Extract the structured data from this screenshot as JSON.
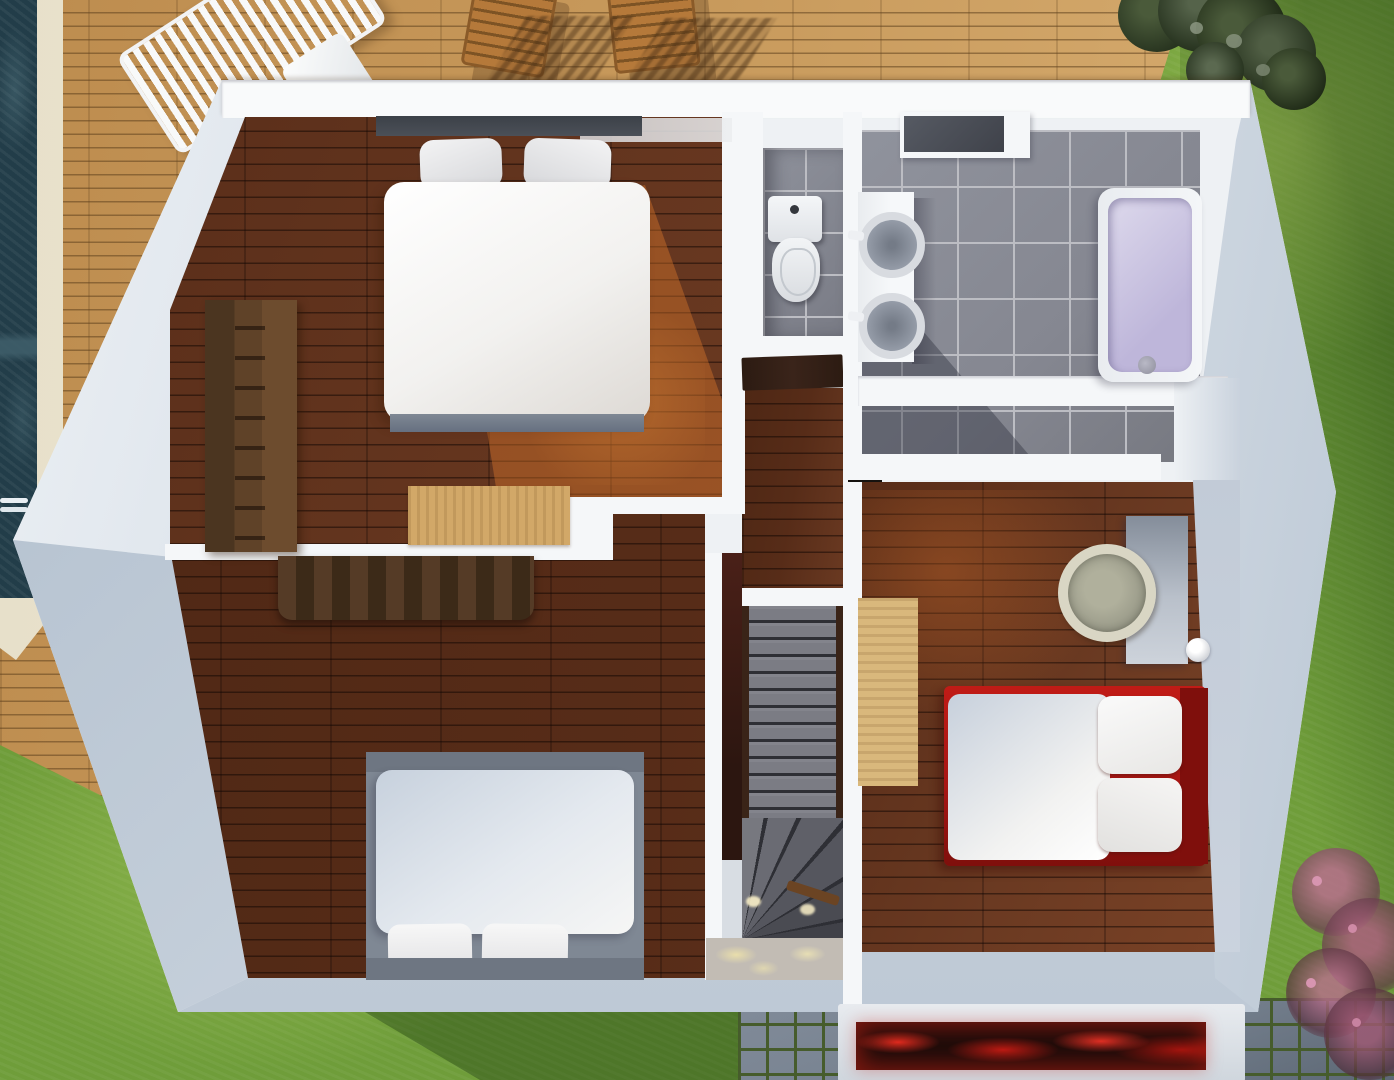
{
  "meta": {
    "description": "Top-down 3D architectural render of an upper-storey floor plan with surrounding garden, wooden pool deck and swimming pool",
    "view": "top-down-perspective",
    "width_px": 1394,
    "height_px": 1080,
    "visible_text": []
  },
  "palette": {
    "grassMid": "#6f9d3a",
    "grassLight": "#8db84e",
    "grassDark": "#45702a",
    "deckWood": "#c89a5c",
    "deckGap": "#936c3b",
    "poolWater": "#223d49",
    "poolStep": "#3e5d69",
    "copingCream": "#f1ebd7",
    "wallWhite": "#f5f7f9",
    "wallShade": "#bac7d6",
    "wallShadeDark": "#aebccb",
    "topBand": "#f9fafb",
    "floorWood": "#6b3a22",
    "floorWoodDark": "#572c18",
    "sunPatch": "#c9722f",
    "tileGray": "#858791",
    "tileGrout": "#bcbdc3",
    "stairTread": "#7b7c84",
    "stairGap": "#2e2f35",
    "stairWallRed": "#4a2018",
    "landing": "#c2bcb4",
    "caustic": "#efe5bc",
    "bedFrame": "#7f8894",
    "headboardDark": "#4b5058",
    "duvetWhite": "#f2f1ef",
    "duvetBlue": "#c7d1dd",
    "pillowWhite": "#ececee",
    "wardrobeBrown": "#5f4228",
    "dresserBrown": "#47311f",
    "rugTan": "#d2a868",
    "rugTan2": "#d9b87c",
    "redBed": "#a81613",
    "redBedDark": "#7f0f0c",
    "tubLavender": "#beb6da",
    "tubLavenderLight": "#ddd9ec",
    "sinkBowl": "#9aa1ad",
    "sinkRing": "#d8dbe0",
    "rattan": "#a9a893",
    "rattanLight": "#d9d6c4",
    "paver": "#75808e",
    "paverJoint": "#465c2c",
    "hedgeDark": "#26321e",
    "hedgeLight": "#4a5a3a",
    "shrubPink": "#b26d89",
    "shrubDark": "#6e4054",
    "flowerRed": "#cf2318",
    "planterDark": "#1a0b09",
    "doorBrown": "#3a241a",
    "furnitureWood": "#b5793a"
  },
  "scene": {
    "outdoor": {
      "pool": {
        "label": "swimming-pool",
        "water_color": "#223d49",
        "edge_color": "#f1ebd7",
        "features": [
          "step-band",
          "white-rail"
        ]
      },
      "deck": {
        "label": "wooden-pool-deck",
        "plank_direction": "horizontal"
      },
      "lawn": {
        "label": "lawn",
        "lighting": "diagonal-sun-and-shadow"
      },
      "hedge": {
        "label": "hedge-shrubs-top-right"
      },
      "pavers": {
        "label": "cobblestone-paving-bottom"
      },
      "planter": {
        "label": "planter-with-red-flowers",
        "flower_color": "#cf2318"
      },
      "pink_shrub": {
        "label": "pink-flowering-shrub-bottom-right"
      },
      "patio_furniture": [
        "white-slatted-lounger",
        "wooden-chair",
        "wooden-chair",
        "chair-shadows"
      ]
    },
    "rooms": [
      {
        "id": "master-bedroom",
        "position": "top-left",
        "floor": "dark-wood",
        "furniture": [
          "double-bed-white",
          "gray-headboard",
          "wardrobe-shelf-unit",
          "tan-rug"
        ]
      },
      {
        "id": "bedroom-2",
        "position": "bottom-left",
        "floor": "dark-wood",
        "furniture": [
          "double-bed-light-blue",
          "dark-dresser"
        ]
      },
      {
        "id": "bedroom-3",
        "position": "right",
        "floor": "dark-wood",
        "furniture": [
          "red-single-bed",
          "desk",
          "rattan-chair",
          "tan-rug",
          "desk-lamp"
        ]
      },
      {
        "id": "wc",
        "position": "top-center",
        "floor": "gray-tile",
        "furniture": [
          "toilet",
          "dark-door"
        ]
      },
      {
        "id": "bathroom",
        "position": "top-right",
        "floor": "gray-tile",
        "furniture": [
          "double-sink-vanity",
          "bathtub-lavender",
          "dark-top-cabinet"
        ]
      },
      {
        "id": "closet-niche",
        "position": "center-right",
        "floor": "dark-wood",
        "furniture": []
      },
      {
        "id": "hallway",
        "position": "center",
        "floor": "dark-wood",
        "furniture": []
      },
      {
        "id": "staircase",
        "position": "center",
        "parts": [
          "white-ledge",
          "straight-flight",
          "winder-steps",
          "landing-with-caustics"
        ]
      }
    ]
  }
}
